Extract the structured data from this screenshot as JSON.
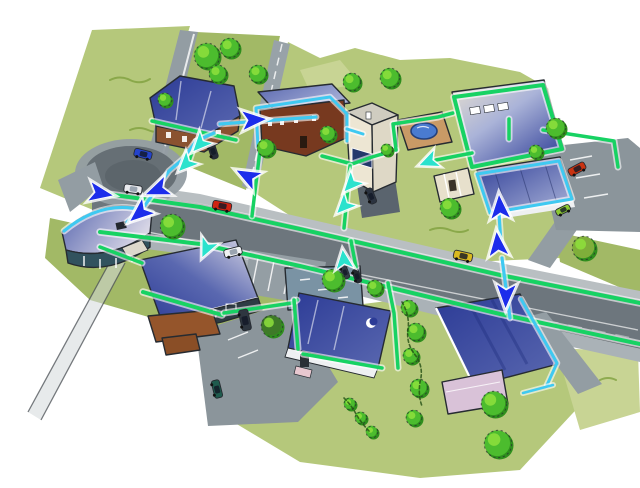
{
  "scene": {
    "type": "illustration",
    "description": "Hand-drawn aerial sketch of a suburban neighborhood: a gray main road with a roundabout, about a dozen blue-roofed buildings, lawns and trees. A glowing green fiber trunk runs along both sides of the main road and loops around buildings; cyan drop lines branch to each house; teal and dark-blue arrows show the direction of network flow.",
    "background": "#ffffff"
  },
  "palette": {
    "paper": "#ffffff",
    "ink": "#262b31",
    "grass": "#b5c87b",
    "grass_dark": "#a2b966",
    "grass_light": "#c8d494",
    "road_main": "#6d767d",
    "road_side": "#939da3",
    "road_light": "#aab2b7",
    "sidewalk": "#b9bfc2",
    "parking": "#8b959b",
    "asphalt_dark": "#5b646a",
    "trunk_green": "#17d263",
    "drop_cyan": "#3fc9f1",
    "arrow_teal": "#2be2cd",
    "arrow_blue": "#1c2deb",
    "roof_deep": "#2c3b96",
    "roof_mid": "#5a68b0",
    "roof_pale": "#aab3d8",
    "roof_silver": "#d9d7e6",
    "roof_tan": "#e9e1cf",
    "wall_brown": "#8a5230",
    "wall_dark_brown": "#77391f",
    "wall_cream": "#ede6d3",
    "wall_cream_shade": "#ded8c6",
    "wall_lavender": "#d9c2d8",
    "wall_white": "#eef0f2",
    "wall_dark_teal": "#31525e",
    "wall_slate": "#7a93a4",
    "annex_brown": "#95552b",
    "pool_blue": "#4a7bd0",
    "deck_tan": "#c99a66",
    "tree_green": "#4cbc2e",
    "tree_light": "#8ee03c",
    "tree_dark": "#2f8f1d",
    "bush_olive": "#7fae3a",
    "bush_deep": "#3e7a28"
  },
  "roads": {
    "items": [
      {
        "id": "roundabout",
        "label": "Roundabout"
      },
      {
        "id": "main-road",
        "label": "Main road"
      },
      {
        "id": "north-street-west",
        "label": "North street (west)"
      },
      {
        "id": "north-street-east",
        "label": "North street (east)"
      },
      {
        "id": "northeast-driveway",
        "label": "Northeast driveway"
      },
      {
        "id": "southeast-lane",
        "label": "Southeast lane"
      },
      {
        "id": "country-lane",
        "label": "Country lane (southwest)"
      },
      {
        "id": "parking-north",
        "label": "Parking lot north-east"
      },
      {
        "id": "parking-central",
        "label": "Parking central"
      },
      {
        "id": "parking-south",
        "label": "Parking lot south"
      }
    ]
  },
  "buildings": [
    {
      "id": "house-northwest",
      "label": "Two-story house with dark blue roof and brown walls"
    },
    {
      "id": "house-brown",
      "label": "Brown house with slate roof"
    },
    {
      "id": "house-tall-cream",
      "label": "Tall cream house with blue window band"
    },
    {
      "id": "pool",
      "label": "Backyard swimming pool with tan deck"
    },
    {
      "id": "hall-north",
      "label": "Large flat-roofed hall with skylights"
    },
    {
      "id": "office-east",
      "label": "Office building with blue roof"
    },
    {
      "id": "rotunda-west",
      "label": "Round-roofed pavilion"
    },
    {
      "id": "hall-southwest",
      "label": "Large building with brown annex"
    },
    {
      "id": "flat-roof-central",
      "label": "Flat slate-roofed building"
    },
    {
      "id": "house-south",
      "label": "House with deep blue roof and white wall"
    },
    {
      "id": "house-southeast",
      "label": "House with blue roof and lavender wall"
    },
    {
      "id": "garden-shed",
      "label": "Garden shed"
    }
  ],
  "vehicles": [
    {
      "id": "car-blue-roundabout",
      "label": "Blue car on roundabout",
      "color": "#2443cc"
    },
    {
      "id": "car-silver-roundabout",
      "label": "Silver car on roundabout",
      "color": "#e9eaee"
    },
    {
      "id": "car-white-parked",
      "label": "White car at parking entrance",
      "color": "#f0f1f3"
    },
    {
      "id": "car-red-mainroad",
      "label": "Red car on main road",
      "color": "#cf2312"
    },
    {
      "id": "car-yellow-mainroad",
      "label": "Yellow car on main road",
      "color": "#d9b91f"
    },
    {
      "id": "car-red-north",
      "label": "Red car in north parking",
      "color": "#c93312"
    },
    {
      "id": "car-van-dark",
      "label": "Dark van beside hall",
      "color": "#2e3640"
    },
    {
      "id": "car-green-dark",
      "label": "Dark green car in south lot",
      "color": "#1f5b4e"
    },
    {
      "id": "car-dark-parked-west",
      "label": "Dark car near north street",
      "color": "#272d38"
    },
    {
      "id": "car-dark-driveway",
      "label": "Dark car on driveway",
      "color": "#2b3340"
    },
    {
      "id": "car-lime-east",
      "label": "Lime car on northeast driveway",
      "color": "#8bc832"
    },
    {
      "id": "car-dark-pair-a",
      "label": "Parked car A",
      "color": "#333a46"
    },
    {
      "id": "car-dark-pair-b",
      "label": "Parked car B",
      "color": "#23282f"
    }
  ],
  "vegetation": {
    "trees_and_bushes": 28,
    "hedgerows": 2
  },
  "network": {
    "trunk_lines": 2,
    "trunk_color_key": "trunk_green",
    "drop_color_key": "drop_cyan",
    "arrows": [
      {
        "id": "a1",
        "style": "teal"
      },
      {
        "id": "a2",
        "style": "teal"
      },
      {
        "id": "a3",
        "style": "teal"
      },
      {
        "id": "a4",
        "style": "teal"
      },
      {
        "id": "a5",
        "style": "teal"
      },
      {
        "id": "a6",
        "style": "teal"
      },
      {
        "id": "a7",
        "style": "teal"
      },
      {
        "id": "b1",
        "style": "blue"
      },
      {
        "id": "b2",
        "style": "blue"
      },
      {
        "id": "b3",
        "style": "blue"
      },
      {
        "id": "b4",
        "style": "blue"
      },
      {
        "id": "b5",
        "style": "blue"
      },
      {
        "id": "b6",
        "style": "blue"
      },
      {
        "id": "b7",
        "style": "blue"
      },
      {
        "id": "b8",
        "style": "blue"
      }
    ]
  }
}
